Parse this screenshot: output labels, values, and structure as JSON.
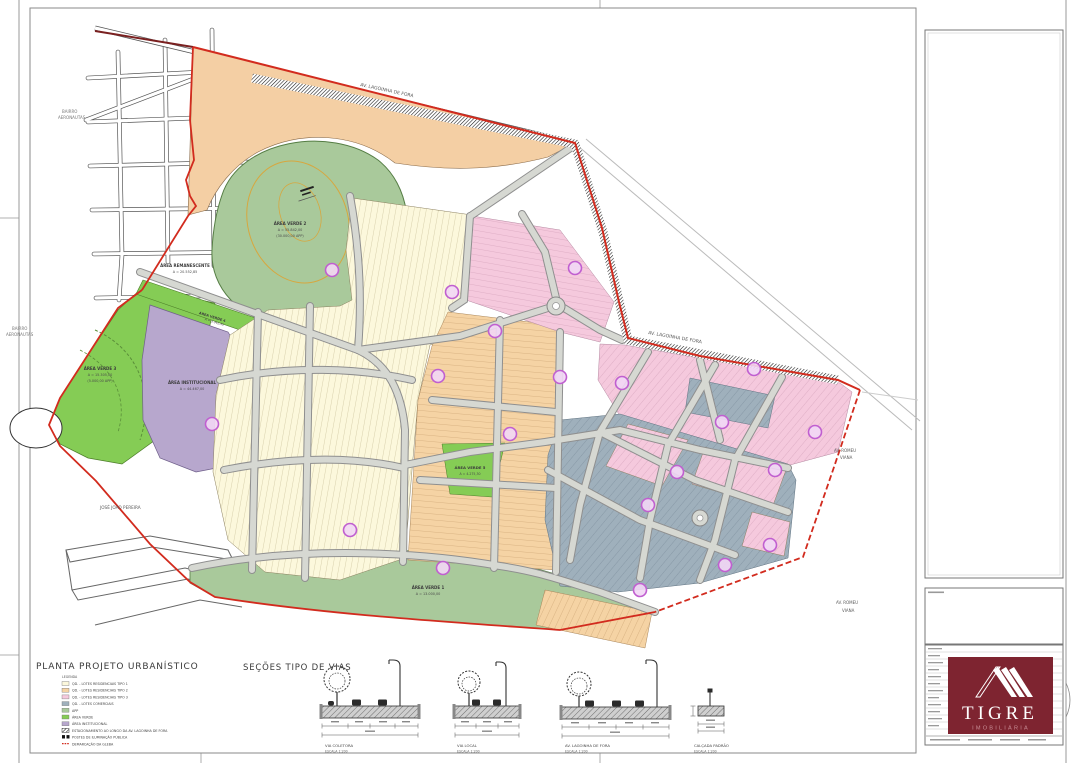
{
  "palette": {
    "boundary_red": "#d22b1e",
    "boundary_darkred": "#7a2020",
    "lots_cream": "#fcf8dc",
    "lots_tan": "#f5d3a4",
    "lots_pink": "#f5c9dd",
    "lots_gray": "#9fb0bc",
    "area_remanescente": "#f4cfa4",
    "green_bright": "#85cc55",
    "green_sage": "#a9c99b",
    "purple_institutional": "#b7a7cd",
    "quadra_marker": "#c05fd0",
    "brand_maroon": "#7e2430",
    "brand_rose": "#c88e96"
  },
  "map": {
    "labels": {
      "bairro_line1": "BAIRRO",
      "bairro_line2": "AERONAUTAS",
      "av_lagoinha": "AV. LAGOINHA DE FORA",
      "av_romeu_line1": "AV. ROMEU",
      "av_romeu_line2": "VIANA",
      "jose_joao": "JOSÉ JOÃO PEREIRA"
    },
    "areas": {
      "remanescente": {
        "l1": "ÁREA REMANESCENTE",
        "l2": "A = 20.552,85"
      },
      "verde2": {
        "l1": "ÁREA VERDE 2",
        "l2": "A = 55.842,00",
        "l3": "(30.000,00 APP)"
      },
      "verde3": {
        "l1": "ÁREA VERDE 3",
        "l2": "A = 15.305,00",
        "l3": "(5.000,00 APP)"
      },
      "verde4": {
        "l1": "ÁREA VERDE 4",
        "l2": "A = 3.342,35"
      },
      "verde5": {
        "l1": "ÁREA VERDE 5",
        "l2": "A = 4.275,30"
      },
      "verde1": {
        "l1": "ÁREA VERDE 1",
        "l2": "A = 13.000,00"
      },
      "institucional": {
        "l1": "ÁREA INSTITUCIONAL",
        "l2": "A = 44.467,00"
      }
    }
  },
  "legend": {
    "title": "PLANTA PROJETO URBANÍSTICO",
    "heading": "LEGENDA",
    "items": [
      {
        "label": "QD. - LOTES RESIDENCIAIS TIPO 1",
        "color": "#fcf8dc"
      },
      {
        "label": "QD. - LOTES RESIDENCIAIS TIPO 2",
        "color": "#f5d3a4"
      },
      {
        "label": "QD. - LOTES RESIDENCIAIS TIPO 3",
        "color": "#f5c9dd"
      },
      {
        "label": "QD. - LOTES COMERCIAIS",
        "color": "#9fb0bc"
      },
      {
        "label": "APP",
        "color": "#a9c99b"
      },
      {
        "label": "ÁREA VERDE",
        "color": "#85cc55"
      },
      {
        "label": "ÁREA INSTITUCIONAL",
        "color": "#b7a7cd"
      },
      {
        "label": "ESTACIONAMENTO AO LONGO DA AV. LAGOINHA DE FORA",
        "color": "#444444"
      },
      {
        "label": "POSTES DE ILUMINAÇÃO PÚBLICA",
        "color": "#111111"
      },
      {
        "label": "DEMARCAÇÃO DA GLEBA",
        "color": "#d22b1e"
      }
    ]
  },
  "sections": {
    "title": "SEÇÕES TIPO DE VIAS",
    "items": [
      {
        "name": "VIA COLETORA",
        "scale": "ESCALA 1:200"
      },
      {
        "name": "VIA LOCAL",
        "scale": "ESCALA 1:200"
      },
      {
        "name": "AV. LAGOINHA DE FORA",
        "scale": "ESCALA 1:200"
      },
      {
        "name": "CALÇADA PADRÃO",
        "scale": "ESCALA 1:200"
      }
    ]
  },
  "brand": {
    "name": "TIGRE",
    "subtitle": "IMOBILIÁRIA"
  }
}
